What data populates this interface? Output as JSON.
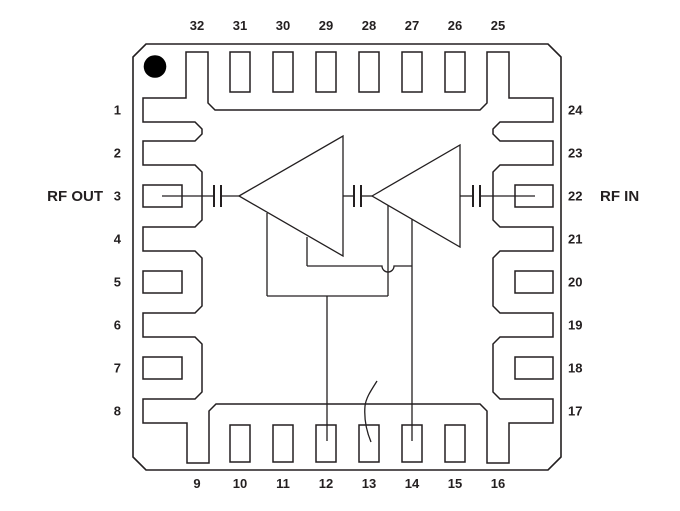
{
  "diagram": {
    "labels": {
      "rf_out": "RF OUT",
      "rf_in": "RF IN"
    },
    "pins": {
      "top": [
        "32",
        "31",
        "30",
        "29",
        "28",
        "27",
        "26",
        "25"
      ],
      "right": [
        "24",
        "23",
        "22",
        "21",
        "20",
        "19",
        "18",
        "17"
      ],
      "bottom": [
        "9",
        "10",
        "11",
        "12",
        "13",
        "14",
        "15",
        "16"
      ],
      "left": [
        "1",
        "2",
        "3",
        "4",
        "5",
        "6",
        "7",
        "8"
      ]
    },
    "rf_out_pin": "3",
    "rf_in_pin": "22",
    "ground_connected_pins": [
      "1",
      "2",
      "4",
      "6",
      "8",
      "9",
      "16",
      "17",
      "19",
      "21",
      "23",
      "24",
      "25",
      "32"
    ],
    "bias_connected_pins": [
      "12",
      "14"
    ],
    "amplifier_stage_count": 2,
    "colors": {
      "line": "#231f20",
      "background": "#ffffff",
      "pin1_dot": "#000000"
    }
  }
}
